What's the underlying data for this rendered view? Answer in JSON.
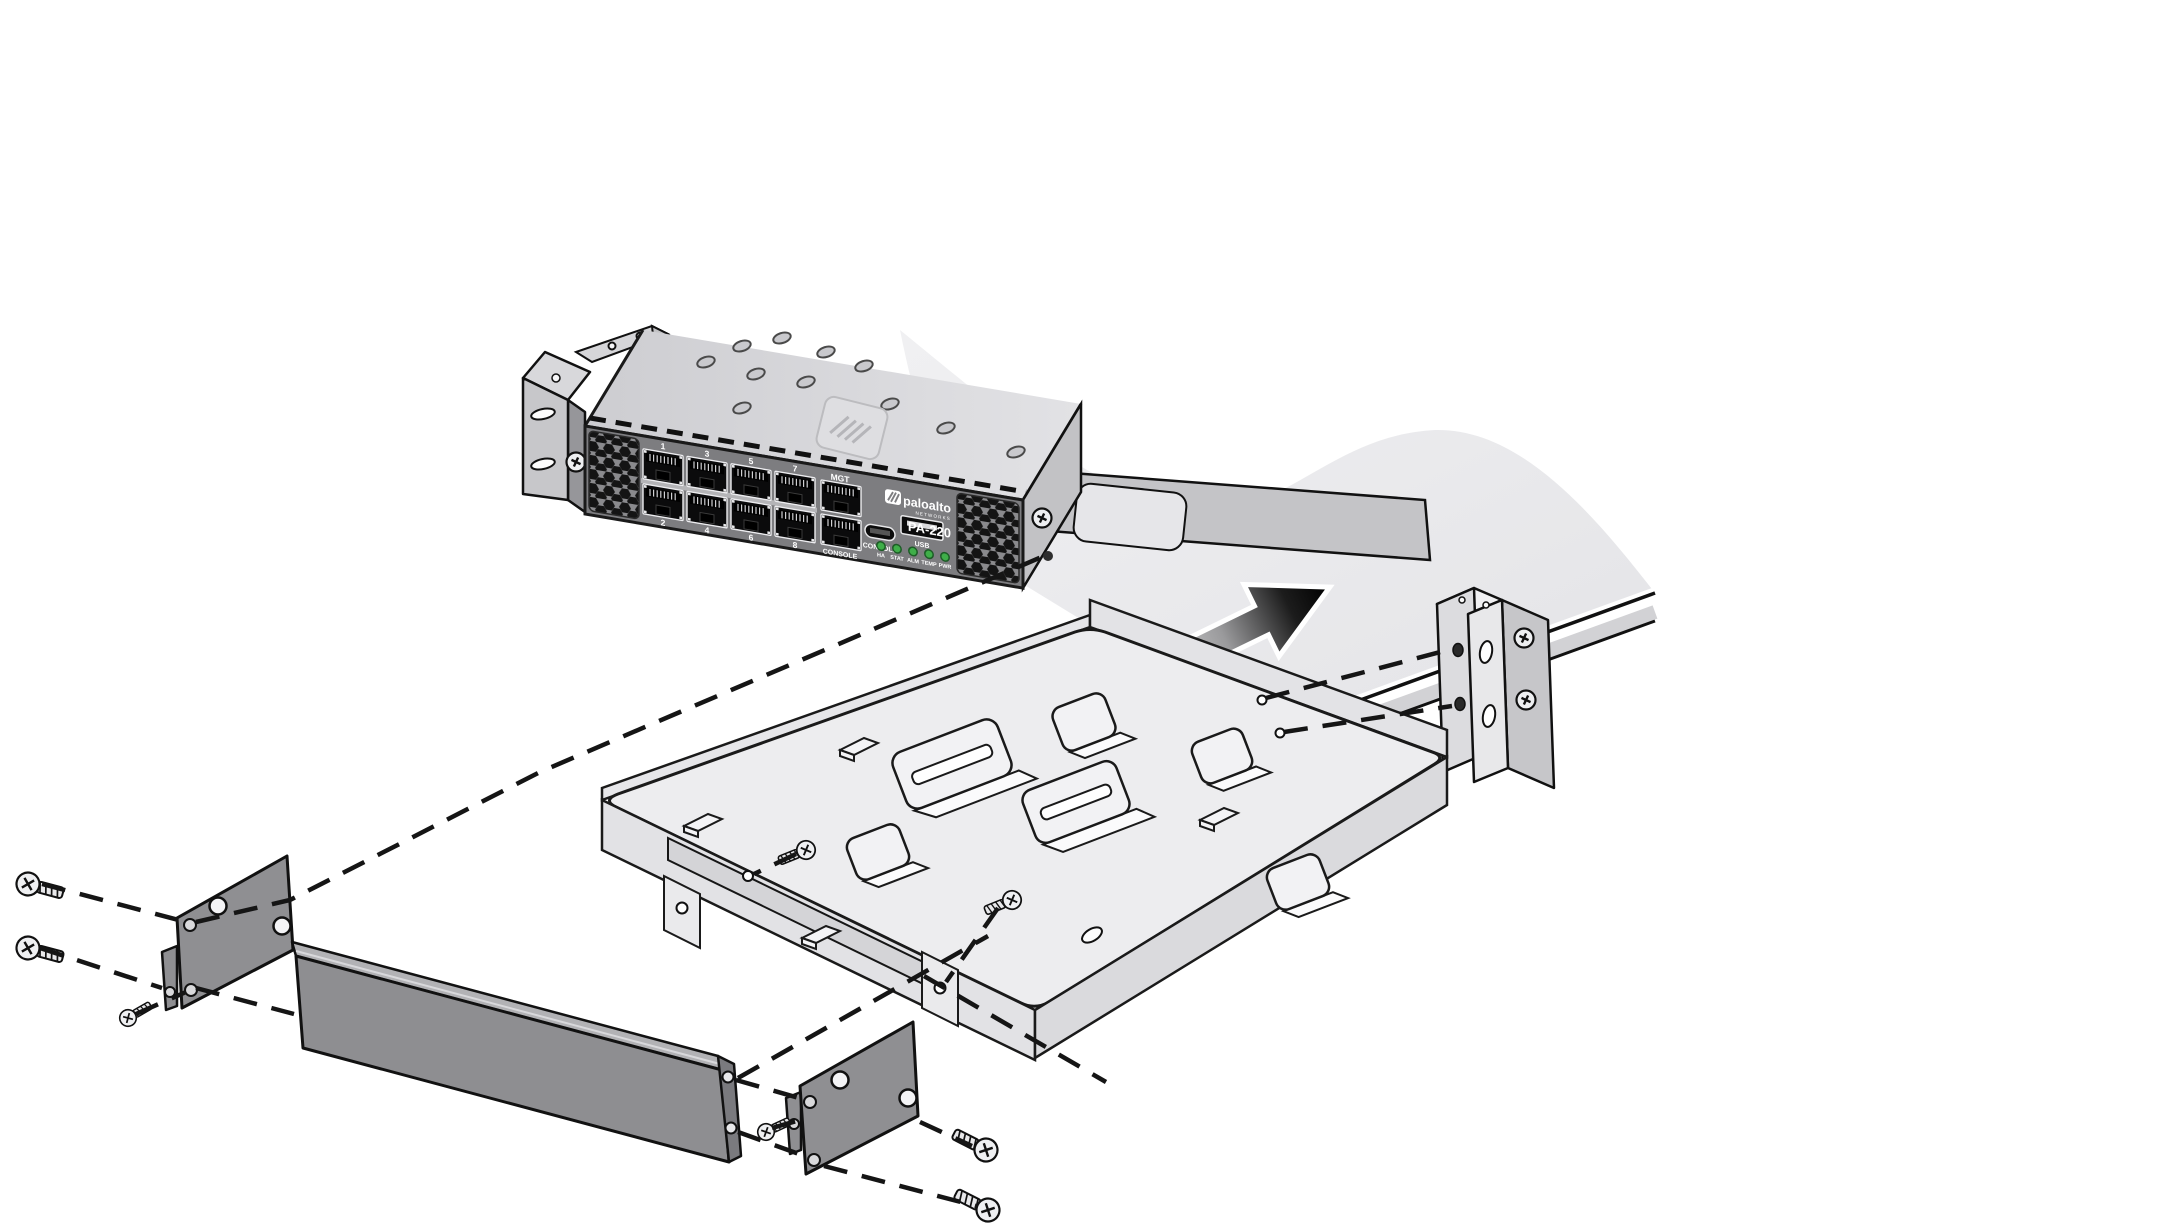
{
  "device": {
    "model": "PA-220",
    "brand": "paloalto",
    "brand_sub": "NETWORKS",
    "mgt_label": "MGT",
    "console_rj45_label": "CONSOLE",
    "console_musb_label": "CONSOLE",
    "usb_label": "USB",
    "port_numbers_top": [
      "1",
      "3",
      "5",
      "7"
    ],
    "port_numbers_bottom": [
      "2",
      "4",
      "6",
      "8"
    ],
    "led_labels": [
      "HA",
      "STAT",
      "ALM",
      "TEMP",
      "PWR"
    ]
  },
  "icons": {
    "insertion_arrow": "arrow-up-right",
    "screw": "phillips-screw",
    "dashed_guides": "alignment-dashed-lines"
  },
  "colors": {
    "outline": "#1a1a1a",
    "front_panel": "#7d7d80",
    "chassis_top": "#d2d2d6",
    "sheet": "#e9e9ec",
    "tray": "#ededef",
    "side_plate": "#8f8f92",
    "blank_panel": "#8e8e91",
    "led_green": "#3fae49",
    "arrow_head": "#000000"
  }
}
